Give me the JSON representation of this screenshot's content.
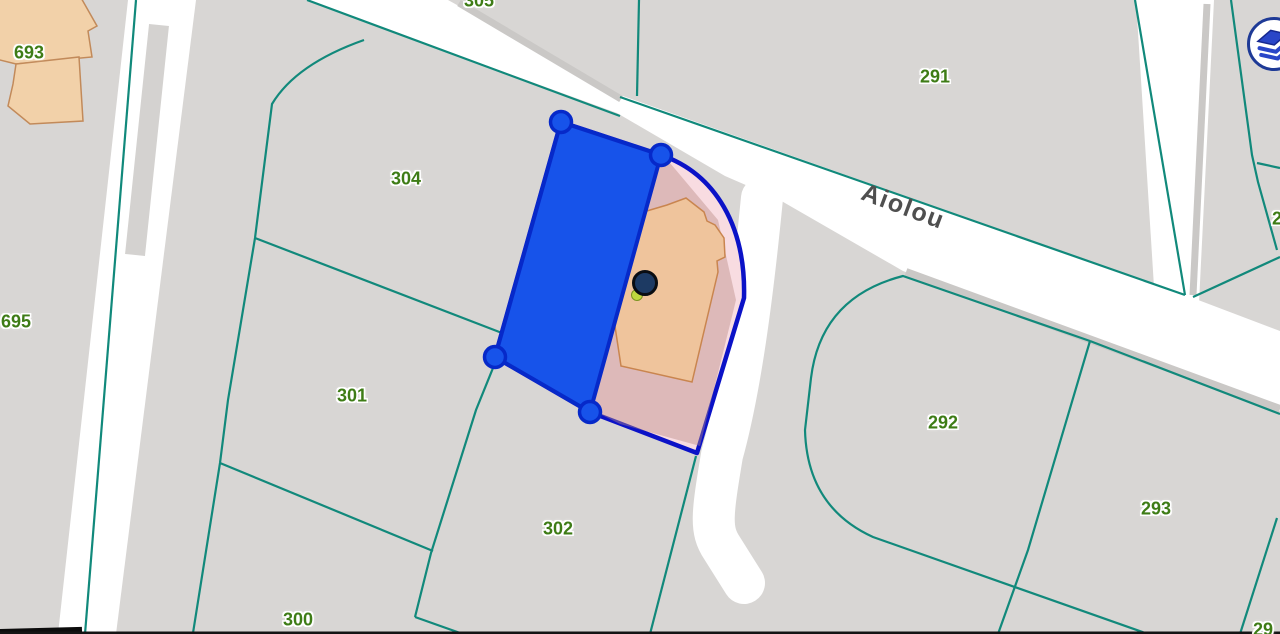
{
  "map": {
    "street_label": "Aiolou",
    "parcel_labels": [
      {
        "id": "693",
        "text": "693"
      },
      {
        "id": "695",
        "text": "695"
      },
      {
        "id": "304",
        "text": "304"
      },
      {
        "id": "301",
        "text": "301"
      },
      {
        "id": "302",
        "text": "302"
      },
      {
        "id": "300",
        "text": "300"
      },
      {
        "id": "305",
        "text": "305"
      },
      {
        "id": "291",
        "text": "291"
      },
      {
        "id": "292",
        "text": "292"
      },
      {
        "id": "293",
        "text": "293"
      },
      {
        "id": "2-partial",
        "text": "2"
      },
      {
        "id": "29-partial",
        "text": "29"
      }
    ],
    "colors": {
      "background_gray": "#d8d6d4",
      "street_white": "#ffffff",
      "boundary_teal": "#11897b",
      "label_green": "#3e7c16",
      "building_tan": "#f2d1a9",
      "selected_parcel_pink": "#f8dce1",
      "selected_parcel_border": "#0b12c7",
      "digitized_polygon_blue": "#1753ea",
      "digitized_polygon_border": "#0629c9",
      "marker_navy": "#1d3a63"
    }
  },
  "controls": {
    "layers_button": {
      "name": "layers",
      "icon": "layers-icon"
    }
  }
}
